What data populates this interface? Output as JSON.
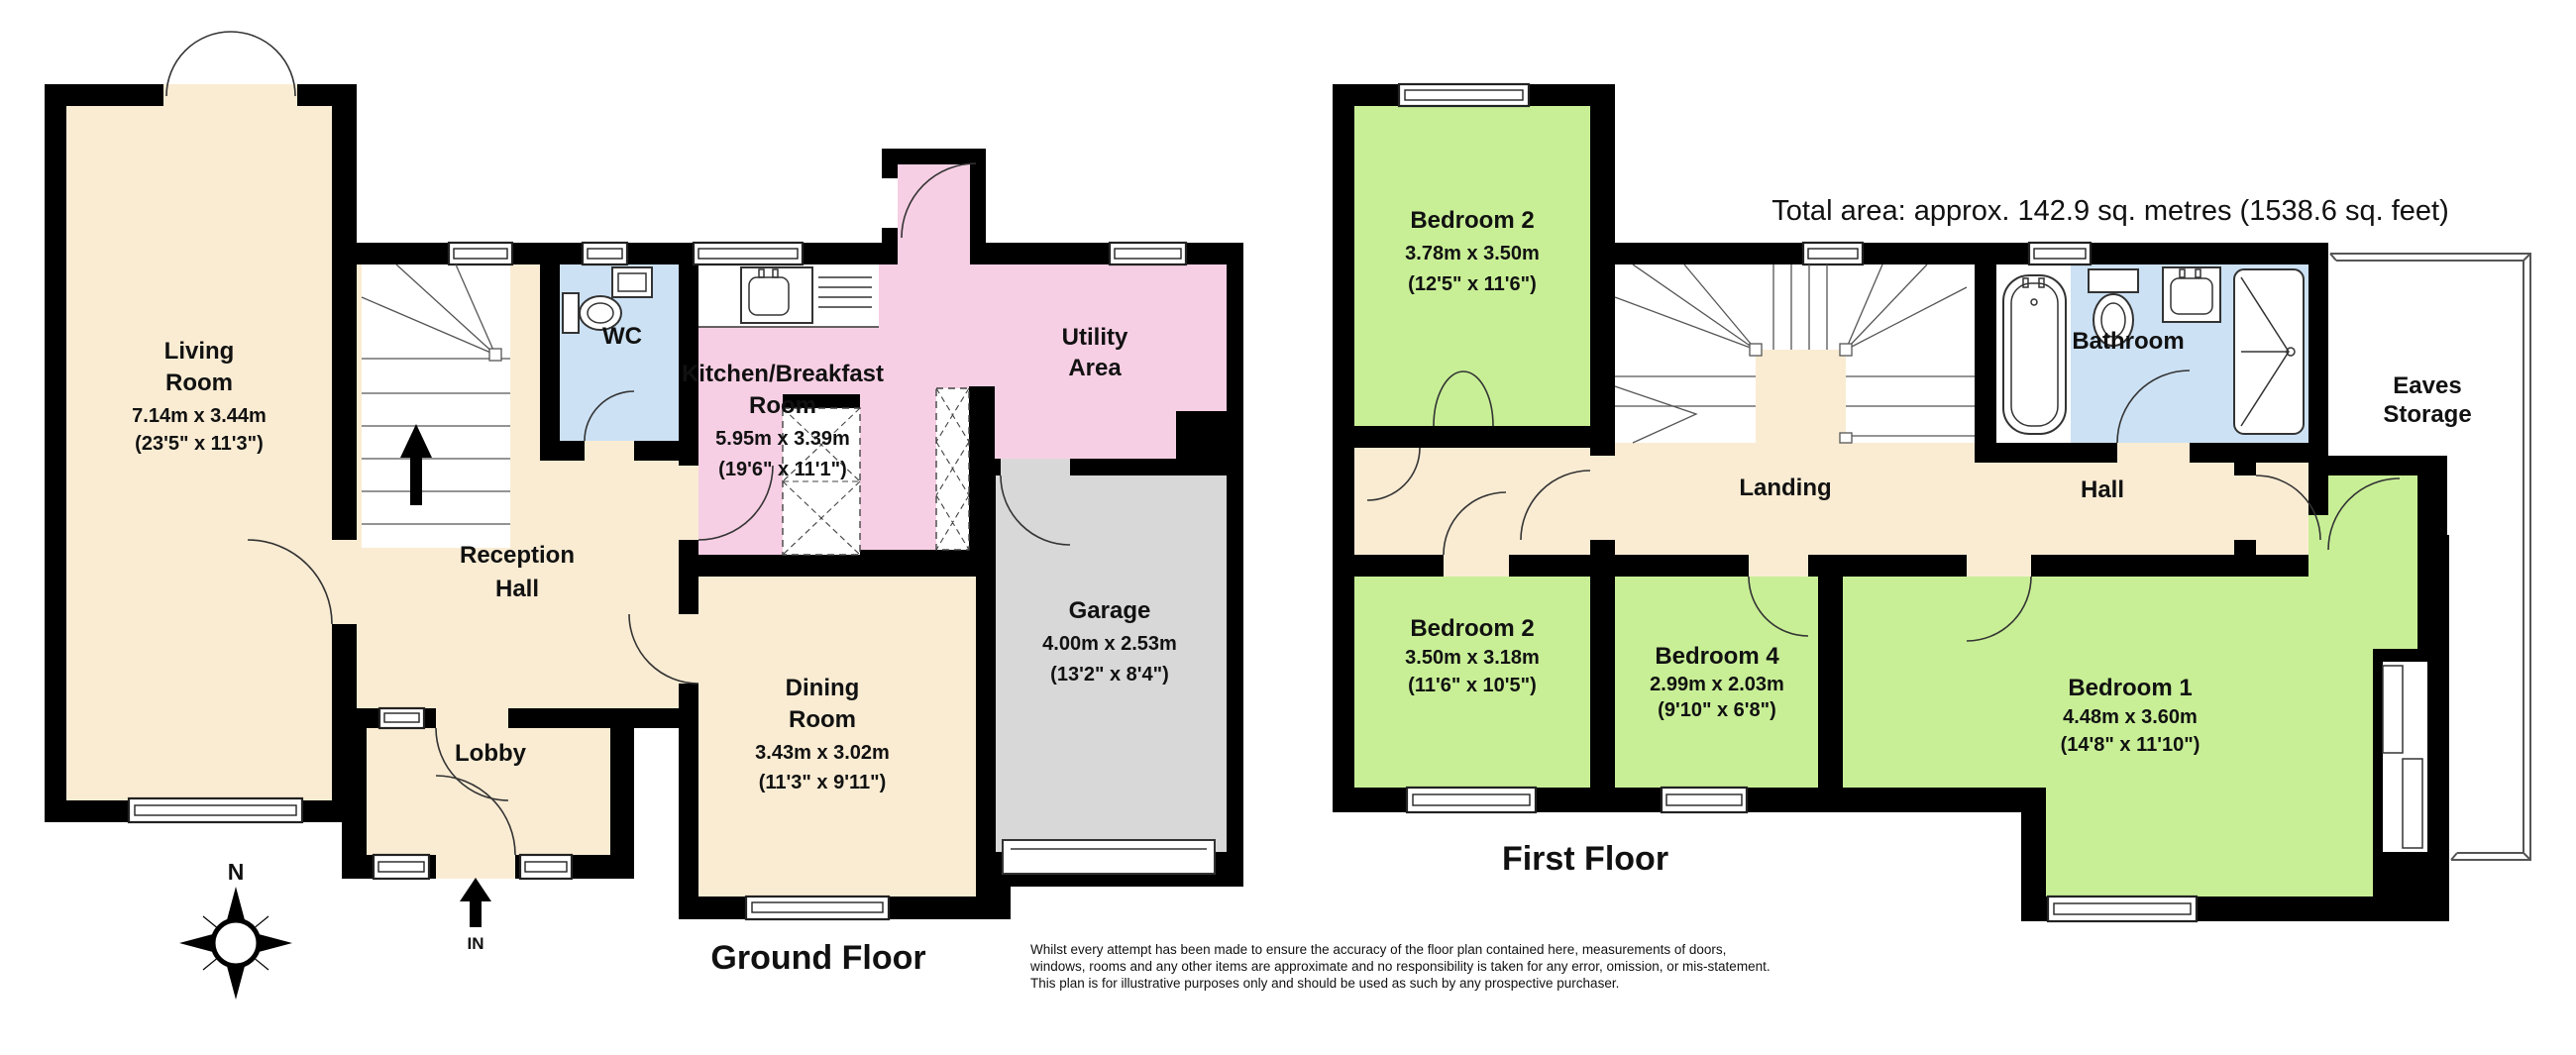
{
  "header": {
    "total_area": "Total area: approx. 142.9 sq. metres (1538.6 sq. feet)"
  },
  "ground_floor": {
    "title": "Ground Floor",
    "entrance_label": "IN",
    "rooms": {
      "living_room": {
        "name_line1": "Living",
        "name_line2": "Room",
        "dims_metric": "7.14m x 3.44m",
        "dims_imperial": "(23'5\" x 11'3\")"
      },
      "wc": {
        "name": "WC"
      },
      "kitchen": {
        "name_line1": "Kitchen/Breakfast",
        "name_line2": "Room",
        "dims_metric": "5.95m x 3.39m",
        "dims_imperial": "(19'6\" x 11'1\")"
      },
      "utility": {
        "name_line1": "Utility",
        "name_line2": "Area"
      },
      "reception_hall": {
        "name_line1": "Reception",
        "name_line2": "Hall"
      },
      "lobby": {
        "name": "Lobby"
      },
      "dining_room": {
        "name_line1": "Dining",
        "name_line2": "Room",
        "dims_metric": "3.43m x 3.02m",
        "dims_imperial": "(11'3\" x 9'11\")"
      },
      "garage": {
        "name": "Garage",
        "dims_metric": "4.00m x 2.53m",
        "dims_imperial": "(13'2\" x 8'4\")"
      }
    }
  },
  "first_floor": {
    "title": "First Floor",
    "rooms": {
      "bedroom2_top": {
        "name": "Bedroom 2",
        "dims_metric": "3.78m x 3.50m",
        "dims_imperial": "(12'5\" x 11'6\")"
      },
      "bathroom": {
        "name": "Bathroom"
      },
      "eaves_storage": {
        "name_line1": "Eaves",
        "name_line2": "Storage"
      },
      "landing": {
        "name": "Landing"
      },
      "hall": {
        "name": "Hall"
      },
      "bedroom2_bottom": {
        "name": "Bedroom 2",
        "dims_metric": "3.50m x 3.18m",
        "dims_imperial": "(11'6\" x 10'5\")"
      },
      "bedroom4": {
        "name": "Bedroom 4",
        "dims_metric": "2.99m x 2.03m",
        "dims_imperial": "(9'10\" x 6'8\")"
      },
      "bedroom1": {
        "name": "Bedroom 1",
        "dims_metric": "4.48m x 3.60m",
        "dims_imperial": "(14'8\" x 11'10\")"
      }
    }
  },
  "compass": {
    "north_label": "N"
  },
  "disclaimer": {
    "line1": "Whilst every attempt has been made to ensure the accuracy of the floor plan contained here, measurements of doors,",
    "line2": "windows, rooms and any other items are approximate and no responsibility is taken for any error, omission, or mis-statement.",
    "line3": "This plan is for illustrative purposes only and should be used as such by any prospective purchaser."
  },
  "colors": {
    "wall": "#000000",
    "room_cream": "#faecd3",
    "room_pink": "#f7cfe4",
    "room_blue": "#cce1f4",
    "room_green": "#c8ef96",
    "room_grey": "#d8d8d8"
  }
}
